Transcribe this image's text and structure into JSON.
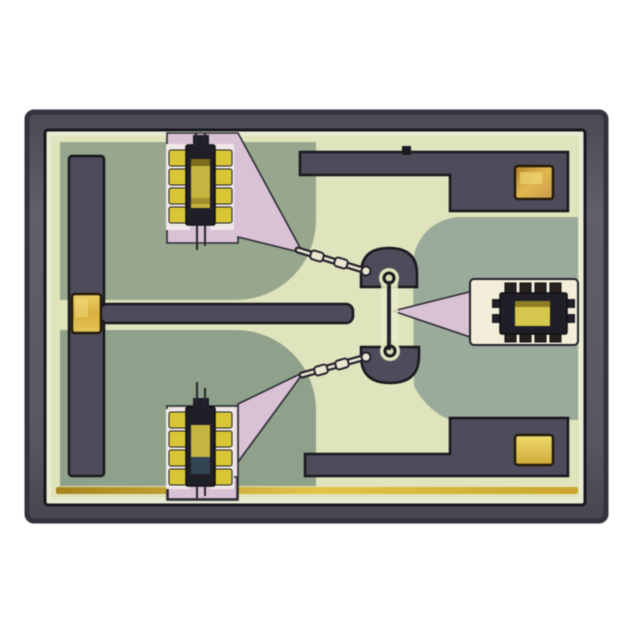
{
  "scene": {
    "type": "photograph",
    "subject": "microscope top-view photograph of an integrated circuit die (MMIC chip) on a white background",
    "die_orientation": "landscape rectangle centered in frame"
  },
  "palette": {
    "page_bg": "#ffffff",
    "frame": "#5a5963",
    "frame_edge": "#34333d",
    "outline_black": "#17171d",
    "ring_pale": "#e9ebd3",
    "substrate_pale": "#e0e4bd",
    "green_left": "#97a78d",
    "green_left2": "#8fa18b",
    "green_right": "#9aab9b",
    "metal": "#4e4c5b",
    "pink": "#d9c2d6",
    "pink_light": "#e9e0e4",
    "cream": "#f2eeda",
    "gold_bright": "#e8cf5e",
    "gold_deep": "#b5812a",
    "gold_bump": "#d9c636",
    "cell_core_gold": "#c6b440",
    "cell_core_dark": "#201f27",
    "gold_edge_line": "#d3ab2c",
    "wire_light": "#ece7d2",
    "teal_core": "#334453"
  },
  "components": {
    "bond_pads": {
      "count": 4,
      "finish": "gold",
      "locations": [
        "left-middle on bias rail",
        "top-right ground trace",
        "bottom-right ground trace",
        "cell cores"
      ]
    },
    "transistor_cells": [
      {
        "location": "top-left",
        "bump_columns": 2,
        "bumps_per_column": 4,
        "surround": "pink mesa with taper to center"
      },
      {
        "location": "bottom-left",
        "bump_columns": 2,
        "bumps_per_column": 4,
        "surround": "pale mesa with taper to center"
      },
      {
        "location": "right-middle",
        "bump_rows": 2,
        "bumps_per_row": 4,
        "surround": "cream region with pink wedge feed"
      }
    ],
    "air_bridge_wires": {
      "count": 2,
      "bridges_per_wire": 2,
      "route": "diagonal from left cells to central stubs"
    },
    "central_stubs": {
      "count": 2,
      "shape": "semicircular metal stubs with via rings linked by vertical trace"
    },
    "bias_tee": {
      "description": "T-shaped horizontal metal bar from left gold pad toward die center"
    },
    "ground_traces": {
      "count": 2,
      "shape": "stepped L-bars along top and bottom edges"
    },
    "edge_feature": "thin gold line along inner bottom edge of die"
  }
}
